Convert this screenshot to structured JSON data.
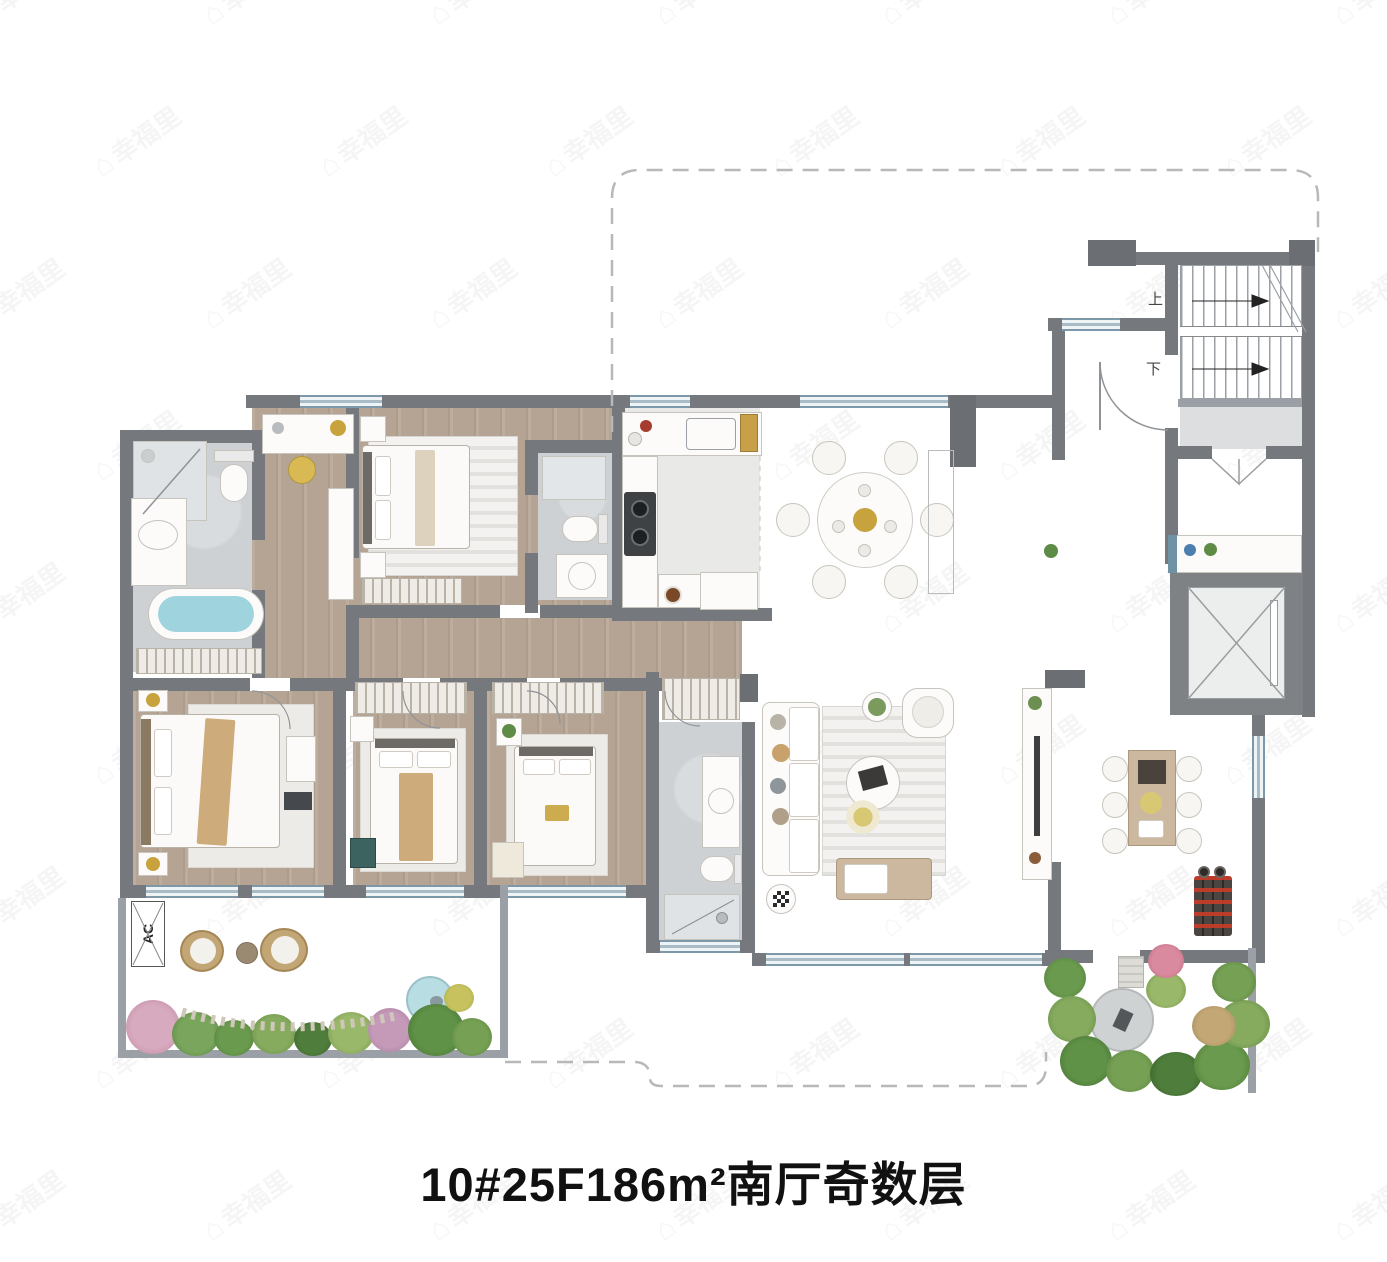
{
  "title": {
    "text": "10#25F186m²南厅奇数层"
  },
  "watermark": {
    "text": "幸福里",
    "icon_name": "house-icon"
  },
  "floor_plan": {
    "labels": {
      "ac_unit": "AC",
      "stairs_up": "上",
      "stairs_down": "下"
    },
    "colors": {
      "wall": "#75787c",
      "window": "#7d98a8",
      "wood_floor": "#b5a493",
      "marble_floor": "#d6d8da",
      "bath_floor": "#cdd1d4",
      "water": "#9fd4de",
      "plant_green": "#5e8c46",
      "plant_pink": "#cf9fb6",
      "accent_gold": "#c8a23c",
      "title_color": "#111111"
    }
  }
}
